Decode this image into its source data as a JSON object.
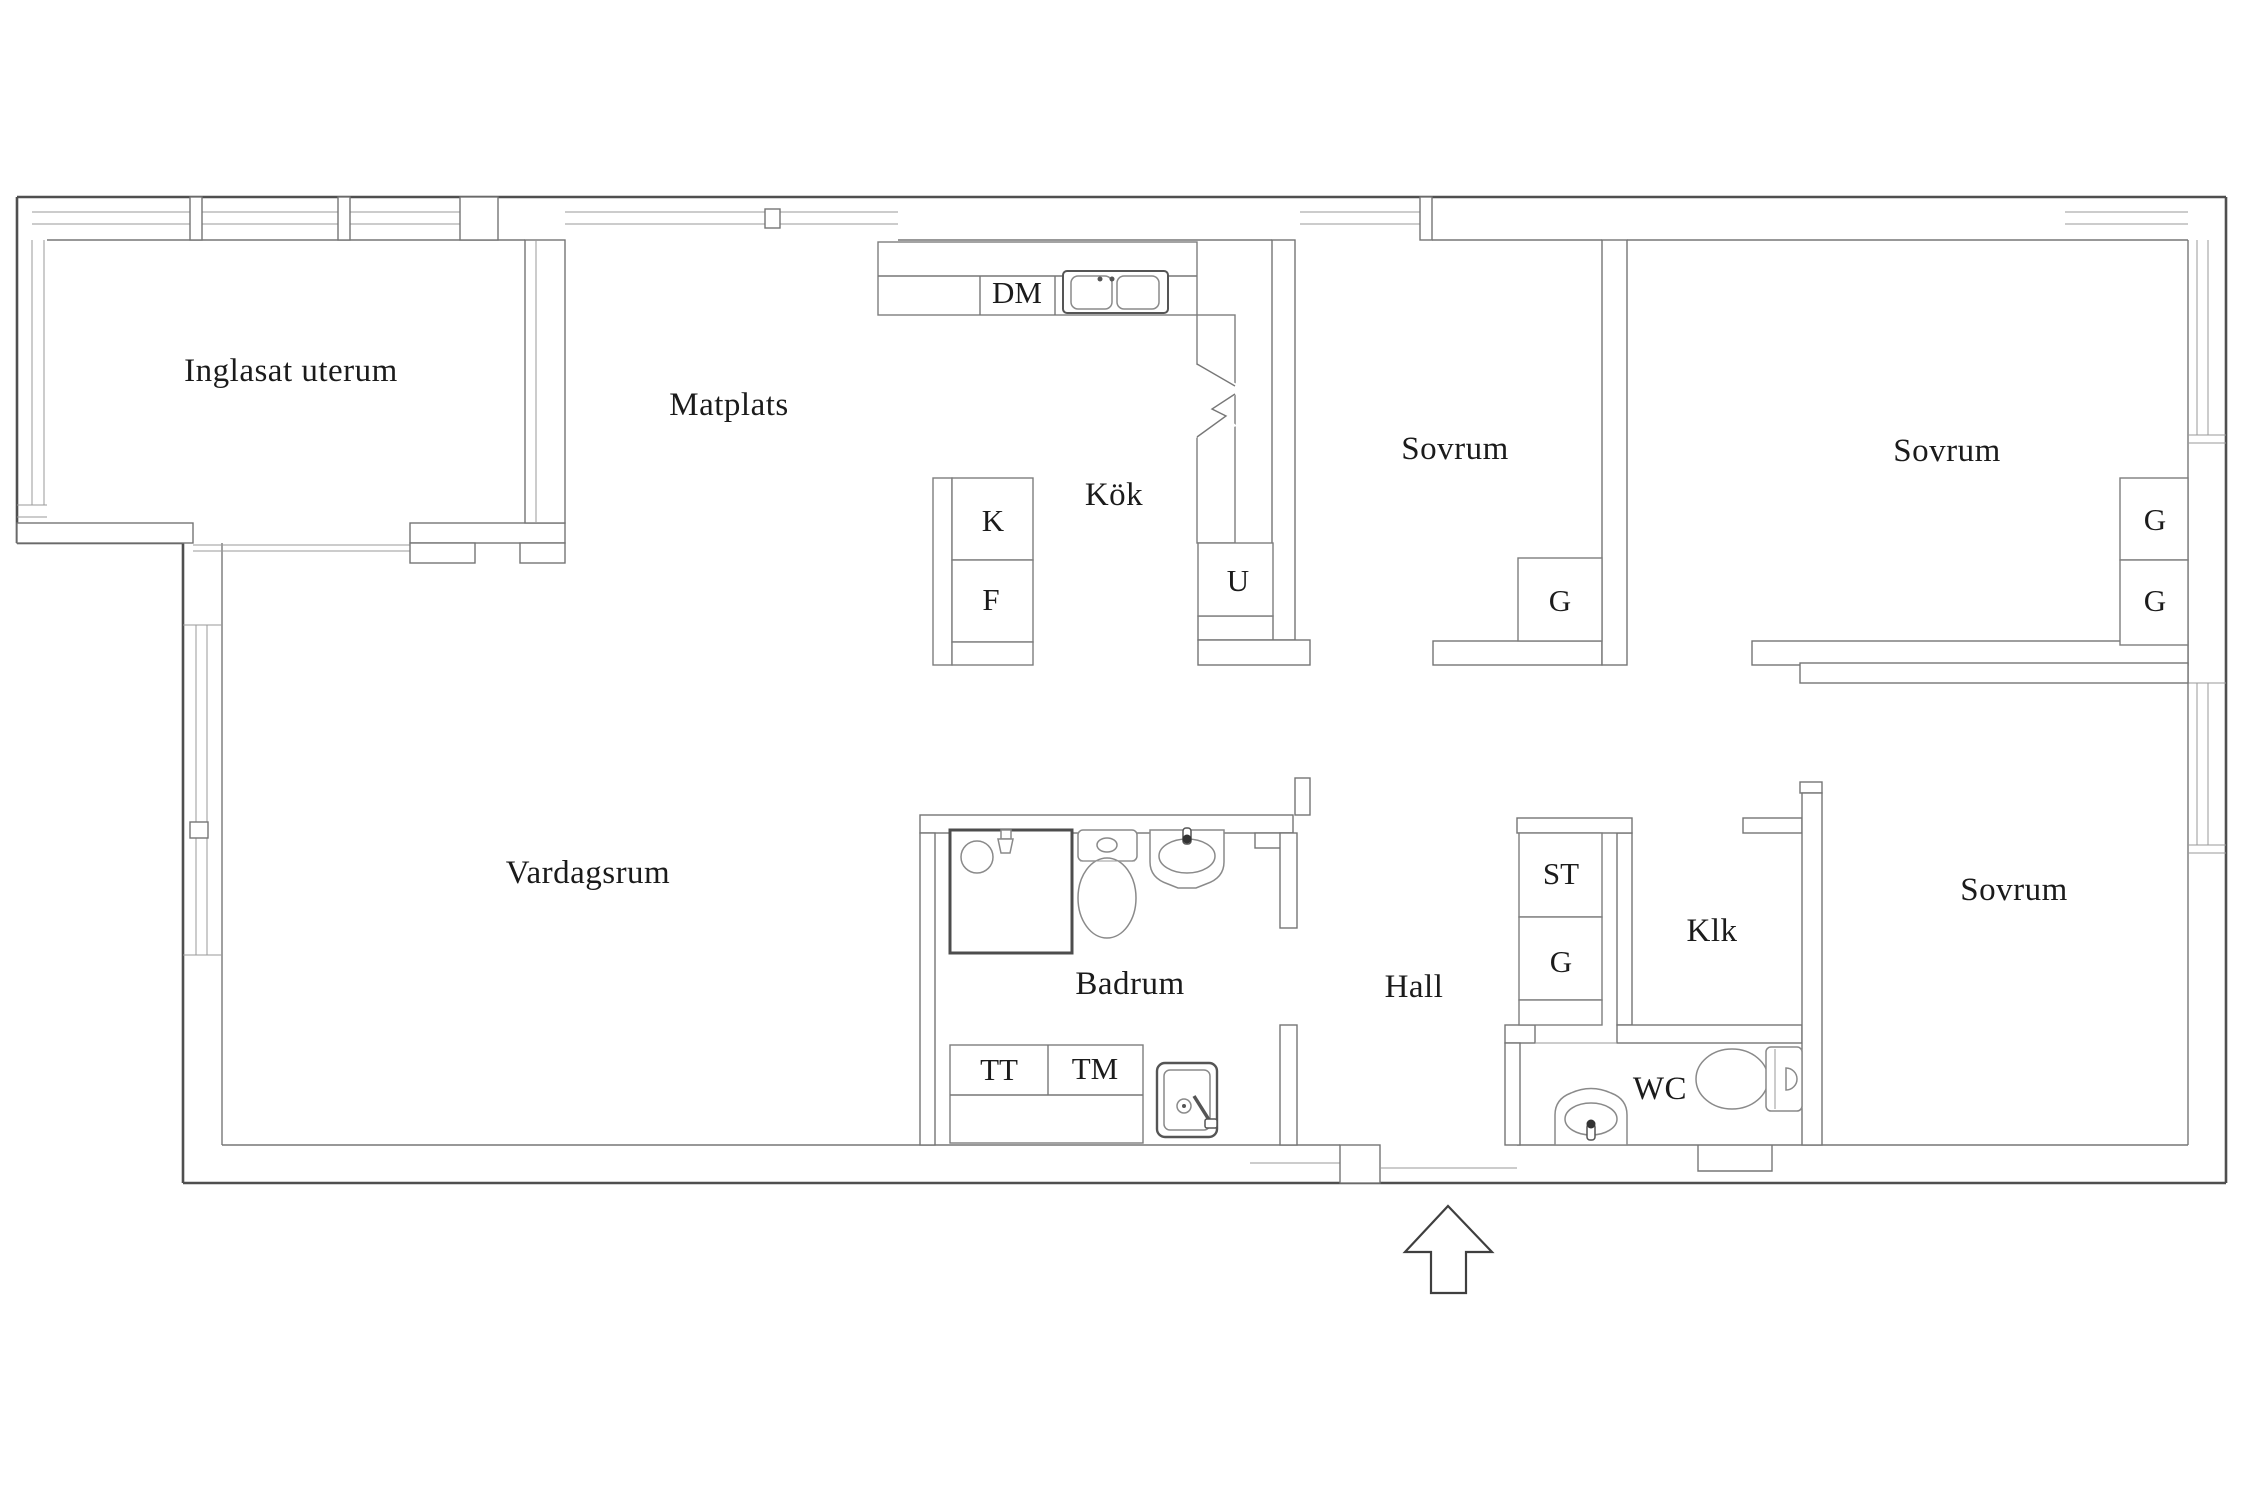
{
  "plan": {
    "title": "apartment-floor-plan",
    "colors": {
      "background": "#ffffff",
      "wall_outline": "#4f4f4f",
      "inner_lines": "#777777",
      "text": "#1b1b1b"
    },
    "rooms": {
      "inglasat_uterum": "Inglasat uterum",
      "matplats": "Matplats",
      "kok": "Kök",
      "sovrum": "Sovrum",
      "vardagsrum": "Vardagsrum",
      "badrum": "Badrum",
      "hall": "Hall",
      "klk": "Klk",
      "wc": "WC"
    },
    "fixtures": {
      "dm": "DM",
      "k": "K",
      "f": "F",
      "u": "U",
      "g": "G",
      "st": "ST",
      "tt": "TT",
      "tm": "TM"
    }
  }
}
